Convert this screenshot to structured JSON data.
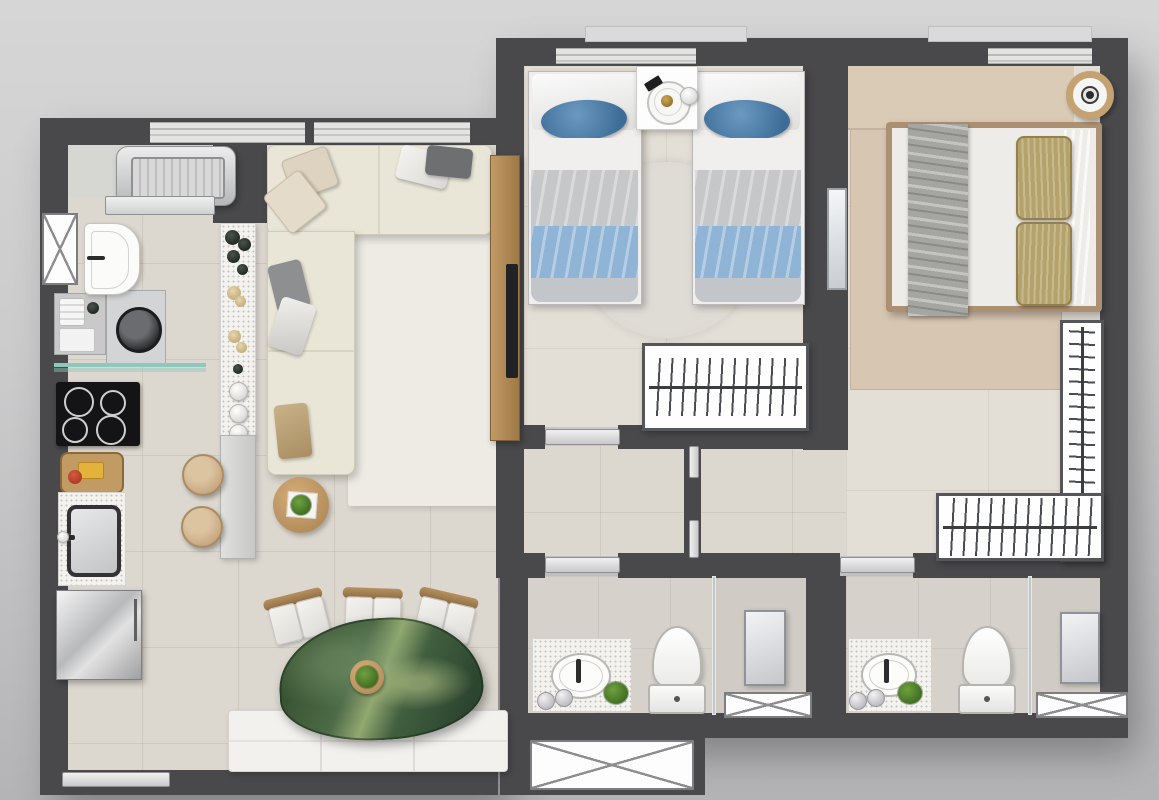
{
  "scene": {
    "label": "Two-bedroom apartment floor plan, top-down 3D render",
    "style": "rendered architectural plan, no text labels"
  },
  "palette": {
    "wall": "#49494c",
    "floorMain": "#dcd7cf",
    "floorBedroom": "#e3ded6",
    "floorBath": "#d6d2cb",
    "balconyFloor": "#d6d6d3",
    "rugLiving": "#edebe4",
    "rugTwin": "#dcd8d1",
    "rugMaster": "#d7c6b2",
    "headboard": "#d9cbb6",
    "sofa": "#e9e6d8",
    "wood": "#b5905e",
    "marbleGreen": "#41603f",
    "bluePillow": "#4c7da9",
    "blueBlanket": "#8fb4d5",
    "khaki": "#b4a26b",
    "benchWhite": "#f2f1ee",
    "glassTeal": "#8fc7bc",
    "steel": "#c9cacc"
  },
  "rooms": {
    "balcony": {
      "label": "service balcony"
    },
    "kitchen": {
      "label": "kitchen and laundry"
    },
    "living": {
      "label": "living and dining room"
    },
    "twin_bedroom": {
      "label": "twin bedroom"
    },
    "master_bedroom": {
      "label": "master bedroom"
    },
    "hallway": {
      "label": "hallway"
    },
    "bathroom1": {
      "label": "bathroom 1"
    },
    "bathroom2": {
      "label": "bathroom 2"
    }
  },
  "furniture": {
    "balcony": [
      "air-conditioning condenser unit",
      "sliding glass door"
    ],
    "kitchen": [
      "laundry sink",
      "washing machine",
      "storage shelf",
      "glass shelf",
      "cooktop",
      "cutting board with food",
      "kitchen sink",
      "refrigerator",
      "bar counter with decor",
      "two bar stools"
    ],
    "living": [
      "l-shaped sofa with pillows",
      "tv panel with tv",
      "round side table with plant",
      "oval green marble dining table",
      "three dining chairs",
      "tufted bench",
      "entrance door threshold"
    ],
    "twin_bedroom": [
      "single bed with blue bedding x2",
      "nightstand with tray and cups",
      "round rug",
      "open closet with hangers",
      "window"
    ],
    "master_bedroom": [
      "double bed with khaki pillows and gray throw",
      "headboard panel",
      "area rug",
      "round wall decor",
      "l-shaped open closet with hangers",
      "mirror panel",
      "window"
    ],
    "bathroom1": [
      "vanity with oval basin",
      "toiletry jars",
      "plant",
      "toilet",
      "glass shower partition",
      "shower glass panel",
      "vent box"
    ],
    "bathroom2": [
      "vanity with oval basin",
      "toiletry jars",
      "plant",
      "toilet",
      "glass shower partition",
      "shower glass panel",
      "vent box"
    ],
    "shafts": [
      "x-marked shaft window",
      "x-marked duct box"
    ]
  }
}
